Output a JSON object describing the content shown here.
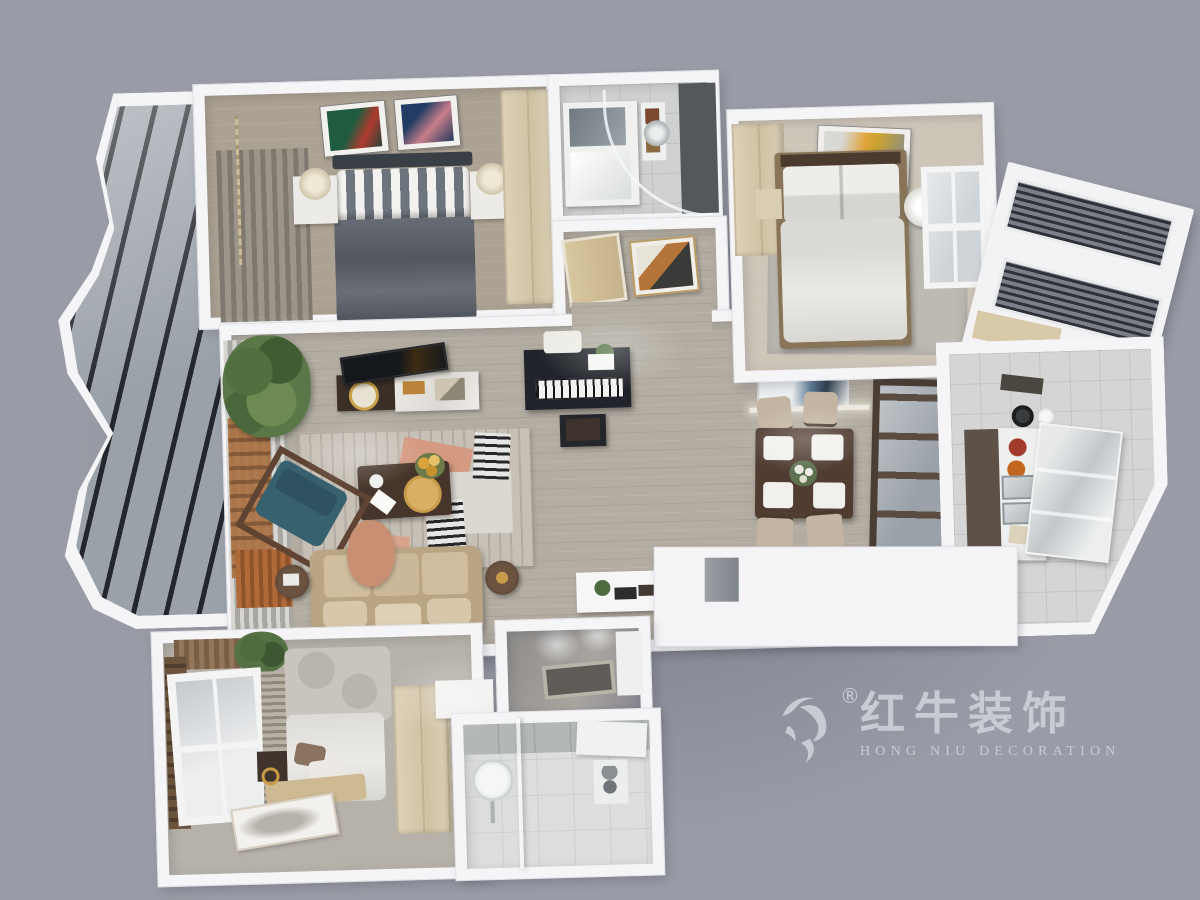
{
  "watermark": {
    "brand_cn": "红牛装饰",
    "brand_en": "HONG NIU DECORATION",
    "registered": "®"
  },
  "palette": {
    "background": "#999ba6",
    "walls": "#f5f5f7",
    "wood_floor": "#b2aca1",
    "bedroom_floor": "#aca293",
    "tile_floor": "#cfd1d1",
    "white_tile": "#dcdddd",
    "dark_duvet": "#5d626c",
    "light_duvet": "#e9e7e2",
    "sofa_beige": "#c6b193",
    "teal_chair": "#39616e",
    "dark_wood": "#46352a",
    "light_wood": "#d9cdb2",
    "glass_dark": "#23262c",
    "glass_light": "#9ba1a9",
    "accent_rust": "#b06a3a",
    "watermark_gray": "#c8cad4"
  },
  "scene": {
    "type": "3d-dollhouse-floorplan-render",
    "rooms": [
      {
        "id": "balcony-left",
        "label": "curved glazed balcony"
      },
      {
        "id": "master-bedroom",
        "label": "bedroom with dark bed, two artworks, wardrobe"
      },
      {
        "id": "master-bathroom",
        "label": "bathroom with vanity and curved shower"
      },
      {
        "id": "entry-hall",
        "label": "entry hall with door and geometric artwork"
      },
      {
        "id": "second-bedroom",
        "label": "bedroom with white bed, yellow artwork, window"
      },
      {
        "id": "balcony-right",
        "label": "angled louvered balcony"
      },
      {
        "id": "living-room",
        "label": "living room with sofa, teal chair, TV, piano"
      },
      {
        "id": "dining-area",
        "label": "dining table with four chairs and shelf partition"
      },
      {
        "id": "kitchen",
        "label": "kitchen with counter, sinks, glass cabinet"
      },
      {
        "id": "third-bedroom",
        "label": "bedroom with window, platform bed, wardrobe"
      },
      {
        "id": "walkin-shower-room",
        "label": "recessed tub room with ceiling lights"
      },
      {
        "id": "lower-bathroom",
        "label": "bathroom with round mirror and glass partition"
      }
    ]
  }
}
